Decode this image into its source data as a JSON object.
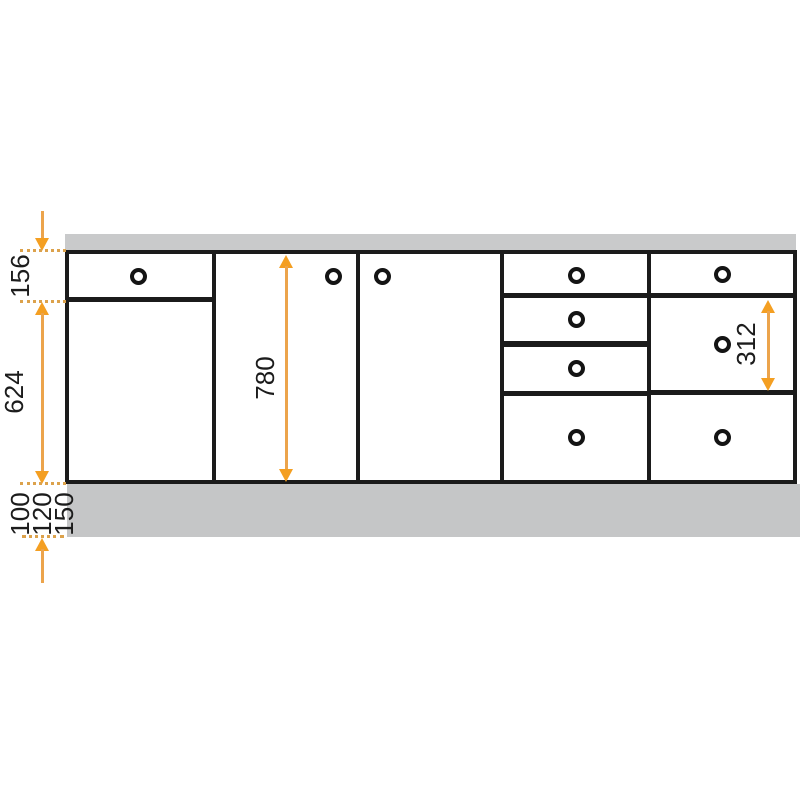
{
  "diagram": {
    "kind": "base-cabinet-elevation-dimension-drawing",
    "labels": {
      "d156": "156",
      "d624": "624",
      "d780": "780",
      "d312": "312",
      "d100": "100",
      "d120": "120",
      "d150": "150"
    },
    "colors": {
      "accent_orange": "#F4A024",
      "dash_orange": "#DCA24C",
      "panel_gray": "#C6C7C8",
      "line_black": "#1B1B1B",
      "background": "#FFFFFF"
    },
    "cabinet": {
      "knob_count": 10,
      "section_count": 5
    }
  }
}
